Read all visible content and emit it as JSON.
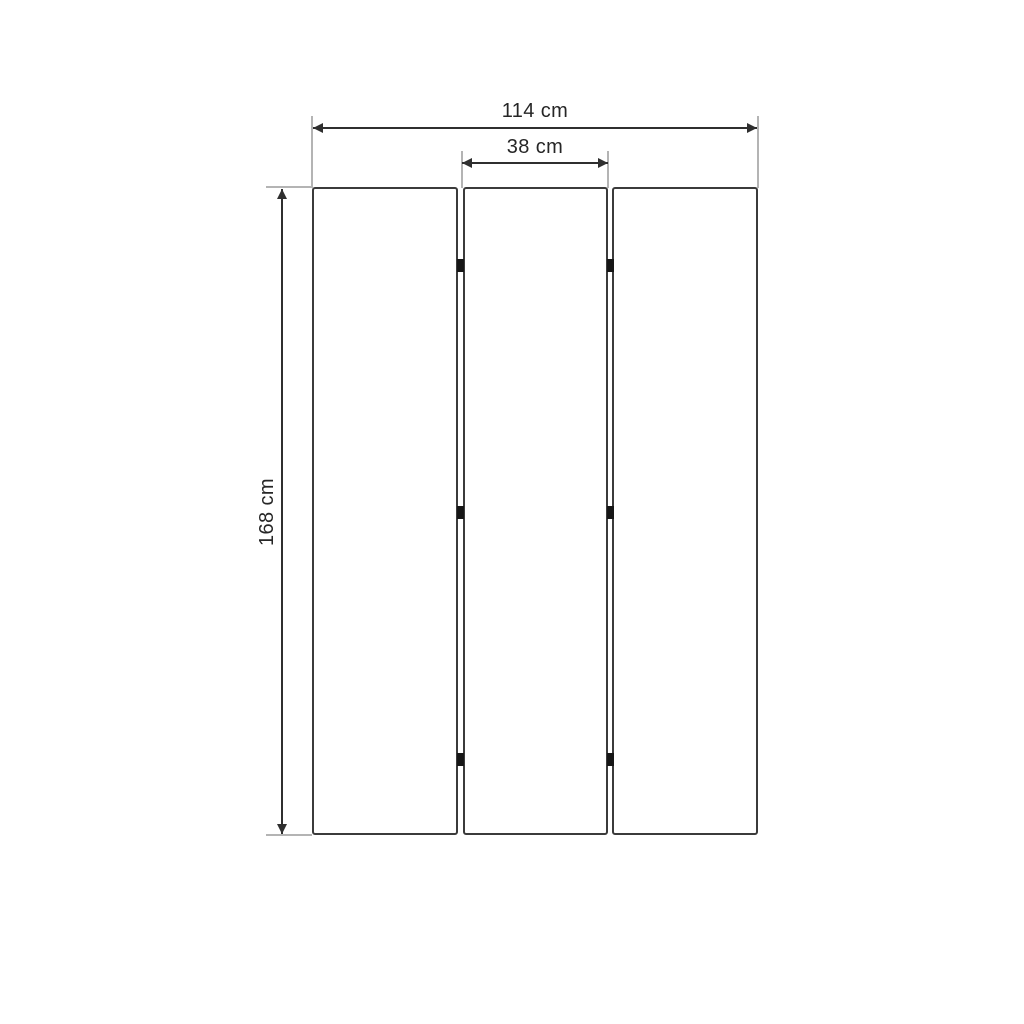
{
  "diagram": {
    "labels": {
      "total_width": "114 cm",
      "panel_width": "38 cm",
      "height": "168 cm"
    },
    "panels": {
      "count": 3,
      "joints": 2,
      "hinges_per_joint": 3
    },
    "colors": {
      "background": "#ffffff",
      "dimension_line": "#2f2f2f",
      "extension_line": "#b4b4b4",
      "panel_border": "#3b3b3b",
      "hinge": "#161616",
      "text": "#262626"
    }
  }
}
